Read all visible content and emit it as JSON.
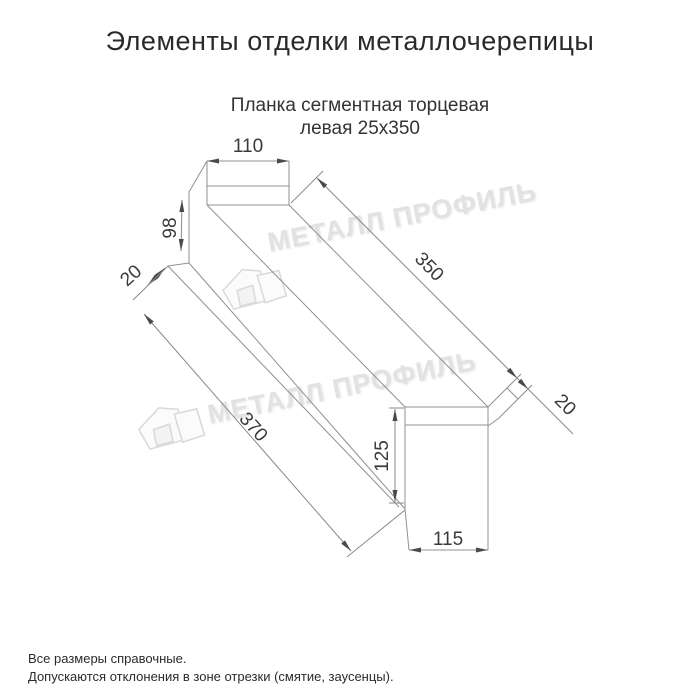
{
  "page": {
    "title": "Элементы отделки металлочерепицы",
    "subtitle_line1": "Планка сегментная торцевая",
    "subtitle_line2": "левая 25х350"
  },
  "drawing": {
    "dim_flange_width": "110",
    "dim_end_height": "98",
    "dim_fold_far": "20",
    "dim_length_top": "350",
    "dim_length_bottom": "370",
    "dim_fold_near": "20",
    "dim_face_height": "125",
    "dim_face_width": "115"
  },
  "watermark": {
    "text1": "МЕТАЛЛ ПРОФИЛЬ",
    "text2": "МЕТАЛЛ ПРОФИЛЬ"
  },
  "footnotes": {
    "line1": "Все размеры справочные.",
    "line2": "Допускаются отклонения в зоне отрезки (смятие, заусенцы)."
  }
}
